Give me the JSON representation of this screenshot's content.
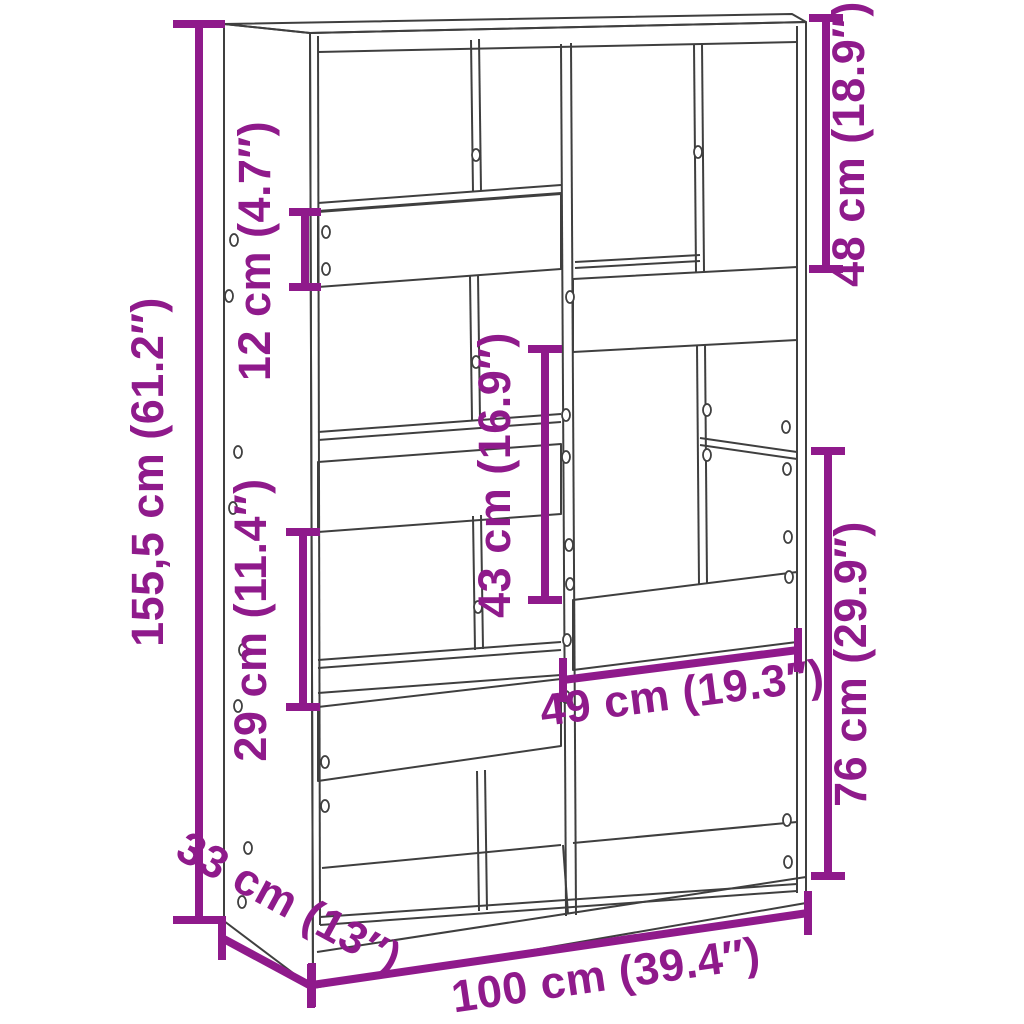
{
  "diagram": {
    "kind": "furniture-dimension-diagram",
    "item": "staggered cube room-divider bookcase line drawing",
    "colors": {
      "dimension_accent": "#8F1A8B",
      "outline": "#3F3F3F",
      "background": "#FFFFFF"
    },
    "dimensions": {
      "total_height": "155,5 cm (61.2″)",
      "shelf_band_12": "12 cm (4.7″)",
      "compartment_29": "29 cm (11.4″)",
      "compartment_43": "43 cm (16.9″)",
      "compartment_48": "48 cm (18.9″)",
      "compartment_76": "76 cm (29.9″)",
      "compartment_width_49": "49 cm (19.3″)",
      "total_width": "100 cm (39.4″)",
      "total_depth": "33 cm (13″)"
    }
  }
}
